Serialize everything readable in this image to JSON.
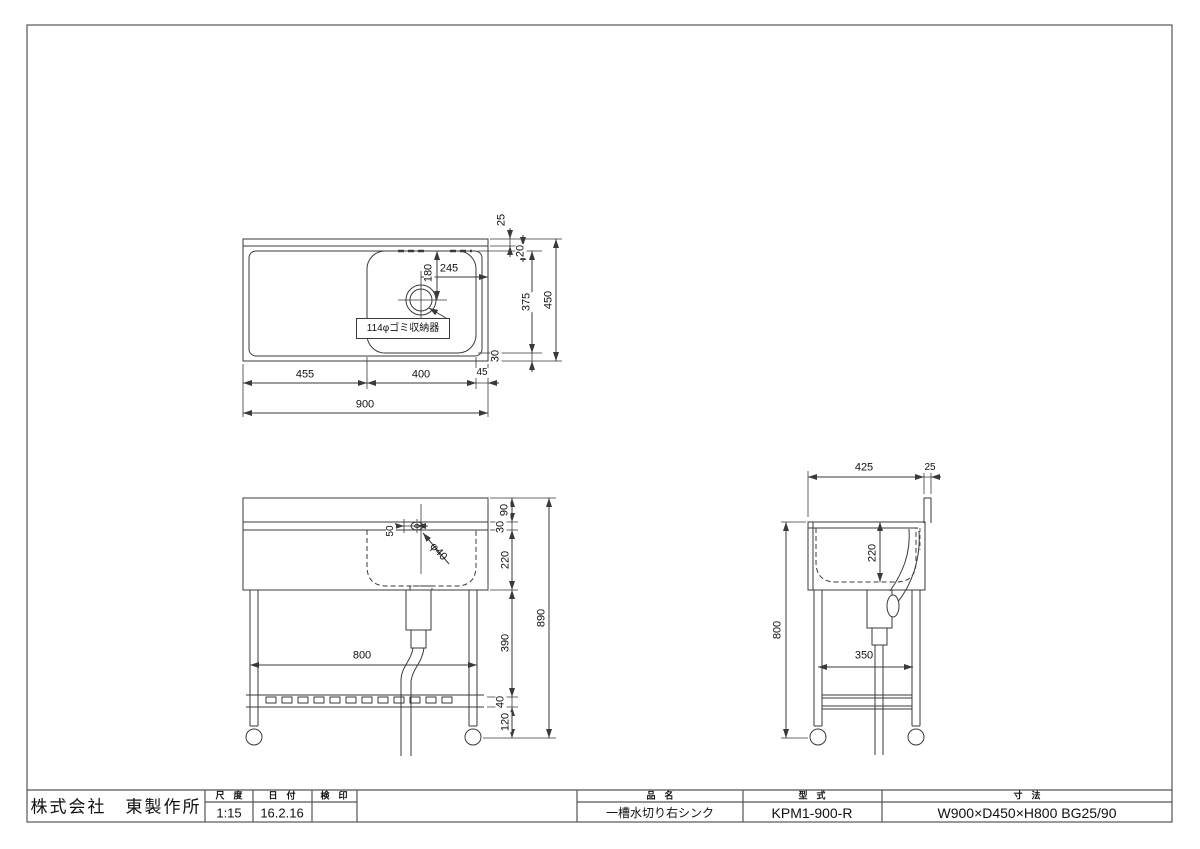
{
  "drawing": {
    "plan": {
      "d455": "455",
      "d400": "400",
      "d45": "45",
      "d900": "900",
      "d25": "25",
      "d20": "20",
      "d375": "375",
      "d30": "30",
      "d450": "450",
      "d245": "245",
      "d180": "180",
      "drain_label": "114φゴミ収納器"
    },
    "front": {
      "d50": "50",
      "phi40": "φ40",
      "d800": "800",
      "d90": "90",
      "d30": "30",
      "d220": "220",
      "d390": "390",
      "d40": "40",
      "d120": "120",
      "d890": "890"
    },
    "side": {
      "d425": "425",
      "d25": "25",
      "d220": "220",
      "d800": "800",
      "d350": "350"
    }
  },
  "title_block": {
    "company": "株式会社　東製作所",
    "scale_label": "尺　度",
    "scale": "1:15",
    "date_label": "日　付",
    "date": "16.2.16",
    "stamp_label": "検　印",
    "stamp": "",
    "product_label": "品　名",
    "product": "一槽水切り右シンク",
    "model_label": "型　式",
    "model": "KPM1-900-R",
    "size_label": "寸　法",
    "size": "W900×D450×H800 BG25/90"
  },
  "line_color": "#3a3a3a"
}
